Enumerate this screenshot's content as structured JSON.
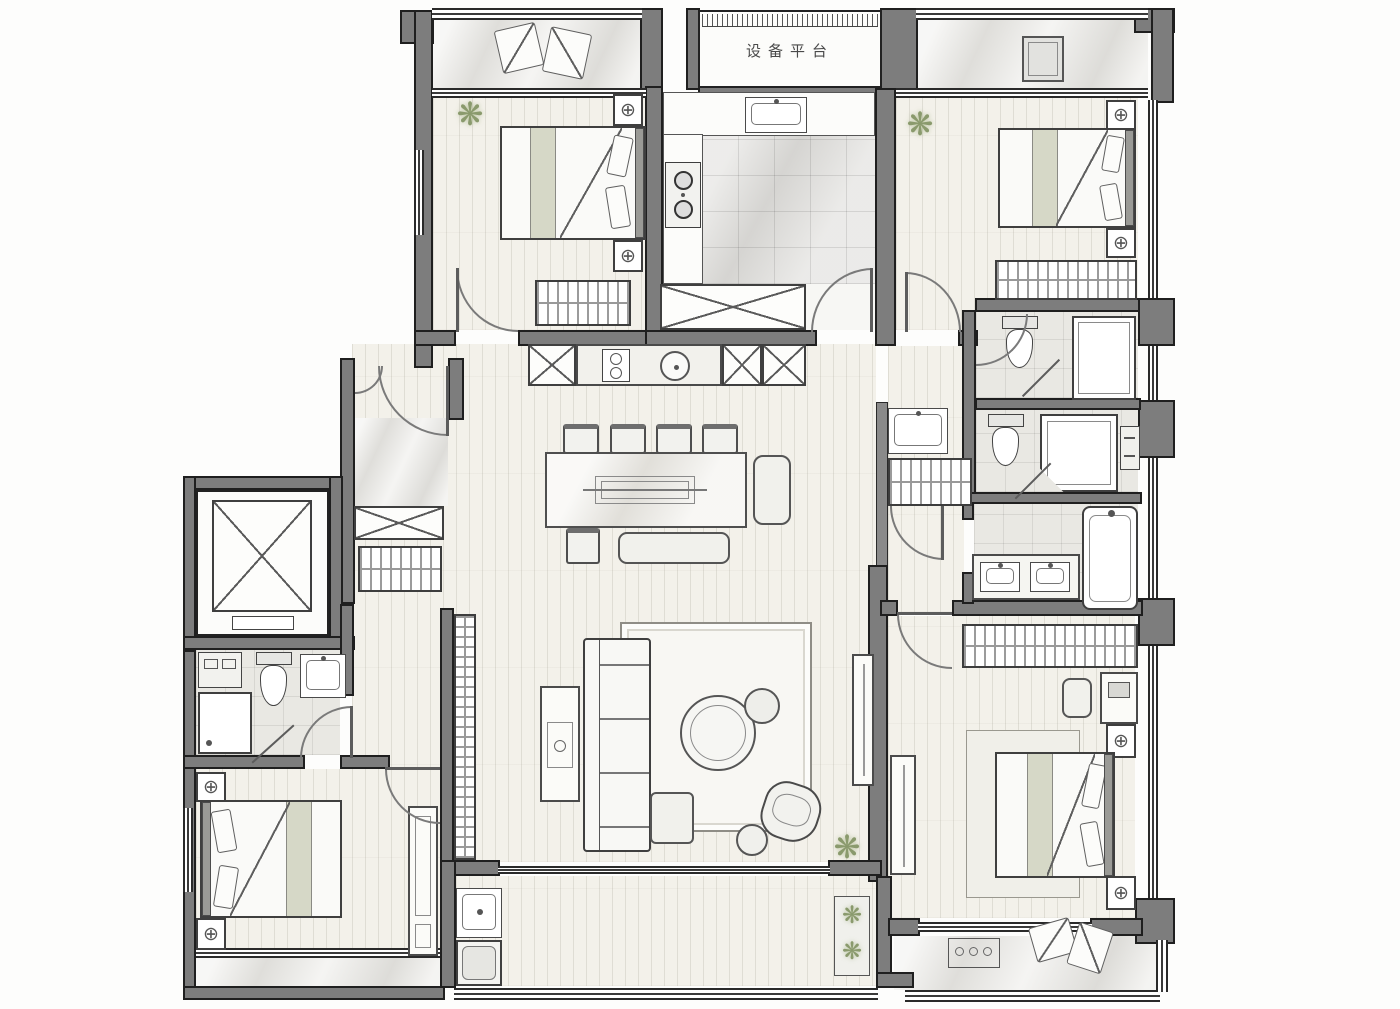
{
  "labels": {
    "equipment_platform": "设备平台"
  },
  "icons": {
    "fan_symbol": "⊕",
    "plant": "❋"
  },
  "colors": {
    "wall_fill": "#7d7d7d",
    "wall_line": "#1f1f1f",
    "wood_floor": "#f3f1ea",
    "tile_floor": "#e9e8e3",
    "marble_floor": "#e9e8e4",
    "furniture_line": "#4b4b4b",
    "bed_accent": "#d6d8c7",
    "plant_green": "#8a9a6d"
  }
}
